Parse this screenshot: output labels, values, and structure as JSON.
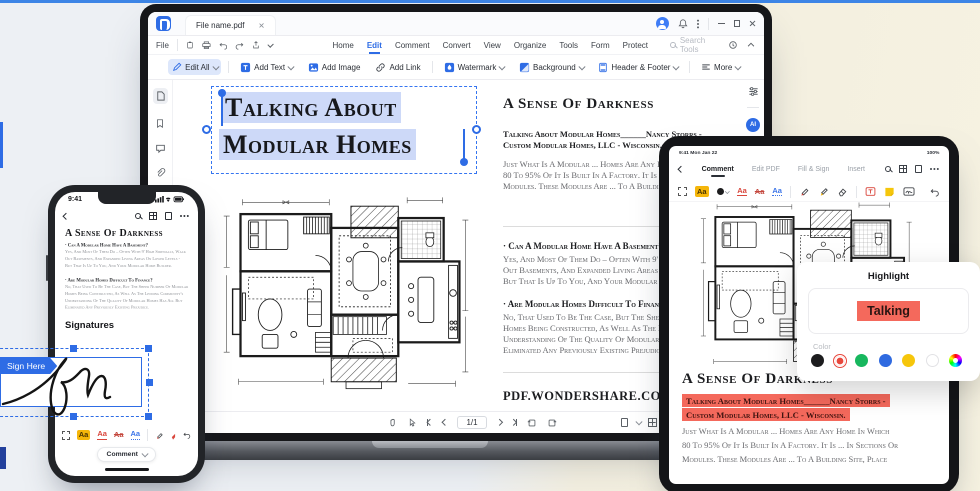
{
  "ui": {
    "format_label": "Aa",
    "accent_blue": "#2e6ce5",
    "highlight_red": "#f4695c",
    "selection_blue": "#cdd9f8"
  },
  "desktop": {
    "tab_title": "File name.pdf",
    "file_menu": "File",
    "menus": [
      "Home",
      "Edit",
      "Comment",
      "Convert",
      "View",
      "Organize",
      "Tools",
      "Form",
      "Protect"
    ],
    "search_placeholder": "Search Tools",
    "ai_badge_label": "AI",
    "toolbar": {
      "edit_all": "Edit All",
      "add_text": "Add Text",
      "add_image": "Add Image",
      "add_link": "Add Link",
      "watermark": "Watermark",
      "background": "Background",
      "header_footer": "Header & Footer",
      "more": "More"
    },
    "statusbar": {
      "page_indicator": "1/1"
    },
    "document": {
      "headline": [
        "Talking About",
        "Modular Homes"
      ],
      "heading": "A Sense Of Darkness",
      "byline": [
        "Talking About Modular Homes______Nancy Storrs -",
        "Custom Modular Homes, LLC - Wisconsin."
      ],
      "intro": [
        "Just What Is A Modular ... Homes Are Any Home In Which",
        "80 To 95% Of It Is Built In A Factory. It Is ... In Sections Or",
        "Modules. These Modules Are ... To A Building Site, Place"
      ],
      "q1_title": "· Can A Modular Home Have A Basement?",
      "q1_body": [
        "Yes, And Most Of Them Do – Often With 9' High Ceilings, Walk",
        "Out Basements, And Expanded Living Areas On Lower Levels -",
        "But That Is Up To You, And Your Modular Home Builder."
      ],
      "q2_title": "· Are Modular Homes Difficult To Finance?",
      "q2_body": [
        "No, That Used To Be The Case, But The Sheer Number Of Modular",
        "Homes Being Constructed, As Well As The Lending Community's",
        "Understanding Of The Quality Of Modular Homes Has All But",
        "Eliminated Any Previously Existing Prejudice."
      ],
      "footer": "PDF.WONDERSHARE.COM"
    }
  },
  "phone": {
    "status_time": "9:41",
    "heading": "A Sense Of Darkness",
    "q1_title": "· Can A Modular Home Have A Basement?",
    "q1_body": [
      "Yes, And Most Of Them Do – Often With 9' High Sidewalls, Walk",
      "Out Basements, And Expanded Living Areas On Lower Levels -",
      "But That Is Up To You, And Your Modular Home Builder."
    ],
    "q2_title": "· Are Modular Homes Difficult To Finance?",
    "q2_body": [
      "No, That Used To Be The Case, But The Sheer Number Of Modular",
      "Homes Being Constructed, As Well As The Lending Community's",
      "Understanding Of The Quality Of Modular Homes Has All But",
      "Eliminated Any Previously Existing Prejudice."
    ],
    "signatures_label": "Signatures",
    "sign_here": "Sign Here",
    "comment_button": "Comment"
  },
  "tablet": {
    "status_left": "9:41  Mon Jan 22",
    "battery": "100%",
    "tabs": [
      "Comment",
      "Edit PDF",
      "Fill & Sign"
    ],
    "insert_label": "Insert",
    "heading": "A Sense Of Darkness",
    "highlight_lines": [
      "Talking About Modular Homes______Nancy Storrs -",
      "Custom Modular Homes, LLC - Wisconsin."
    ],
    "intro": [
      "Just What Is A Modular ... Homes Are Any Home In Which",
      "80 To 95% Of It Is Built In A Factory. It Is ... In Sections Or",
      "Modules. These Modules Are ... To A Building Site, Place"
    ]
  },
  "popup": {
    "title": "Highlight",
    "preview_text": "Talking",
    "color_label": "Color",
    "highlight_color": "#f4695c",
    "colors": [
      "#1c1c1e",
      "#e8473c",
      "#17b75e",
      "#2f6ae0",
      "#f6c60b",
      "#ffffff",
      "rainbow"
    ],
    "selected_color": "#e8473c"
  }
}
